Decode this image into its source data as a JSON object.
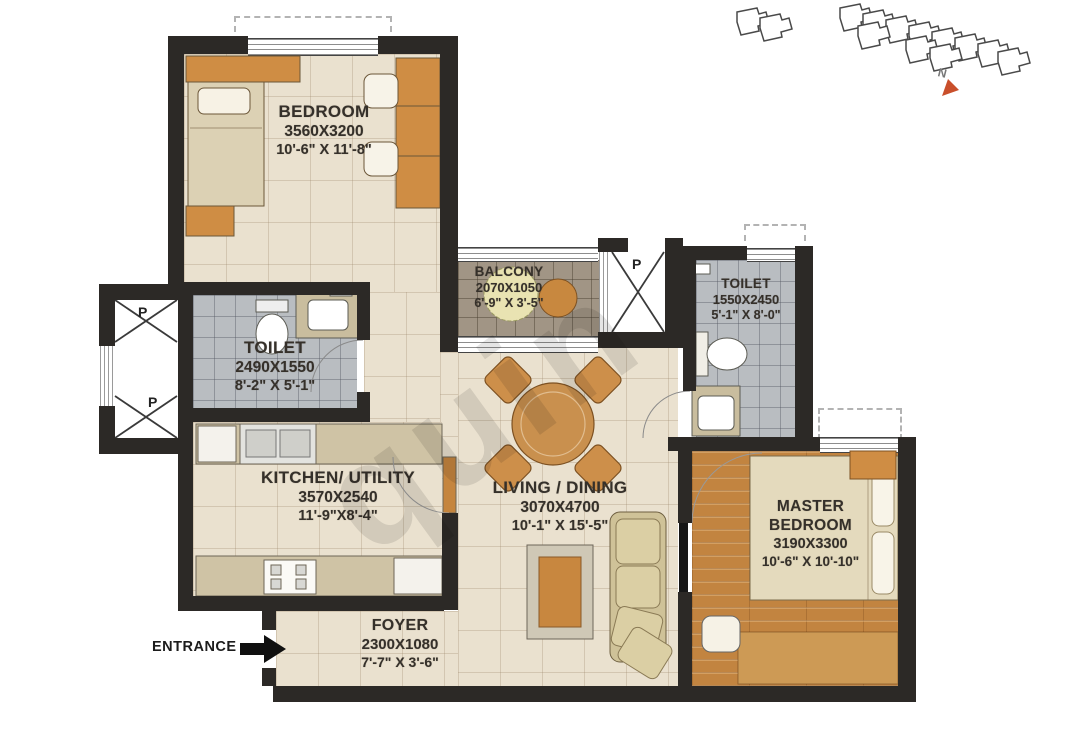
{
  "plan": {
    "type": "apartment-floor-plan-2bhk"
  },
  "rooms": {
    "bedroom": {
      "name": "BEDROOM",
      "dims_mm": "3560X3200",
      "dims_ft": "10'-6\" X 11'-8\""
    },
    "toilet1": {
      "name": "TOILET",
      "dims_mm": "2490X1550",
      "dims_ft": "8'-2\" X 5'-1\""
    },
    "balcony": {
      "name": "BALCONY",
      "dims_mm": "2070X1050",
      "dims_ft": "6'-9\" X 3'-5\""
    },
    "toilet2": {
      "name": "TOILET",
      "dims_mm": "1550X2450",
      "dims_ft": "5'-1\" X 8'-0\""
    },
    "kitchen": {
      "name": "KITCHEN/ UTILITY",
      "dims_mm": "3570X2540",
      "dims_ft": "11'-9\"X8'-4\""
    },
    "living": {
      "name": "LIVING / DINING",
      "dims_mm": "3070X4700",
      "dims_ft": "10'-1\" X 15'-5\""
    },
    "master": {
      "name": "MASTER BEDROOM",
      "dims_mm": "3190X3300",
      "dims_ft": "10'-6\" X 10'-10\""
    },
    "foyer": {
      "name": "FOYER",
      "dims_mm": "2300X1080",
      "dims_ft": "7'-7\" X 3'-6\""
    }
  },
  "entrance": {
    "label": "ENTRANCE"
  },
  "ducts": {
    "p": "P"
  },
  "north_label": "N",
  "watermark": "quin",
  "colors": {
    "wall": "#2c2926",
    "furniture_wood": "#cf8d44",
    "wood_floor": "#c28440",
    "toilet_floor": "#b9bdc1",
    "balcony_floor": "#a19585",
    "north_arrow": "#c94f2b"
  }
}
